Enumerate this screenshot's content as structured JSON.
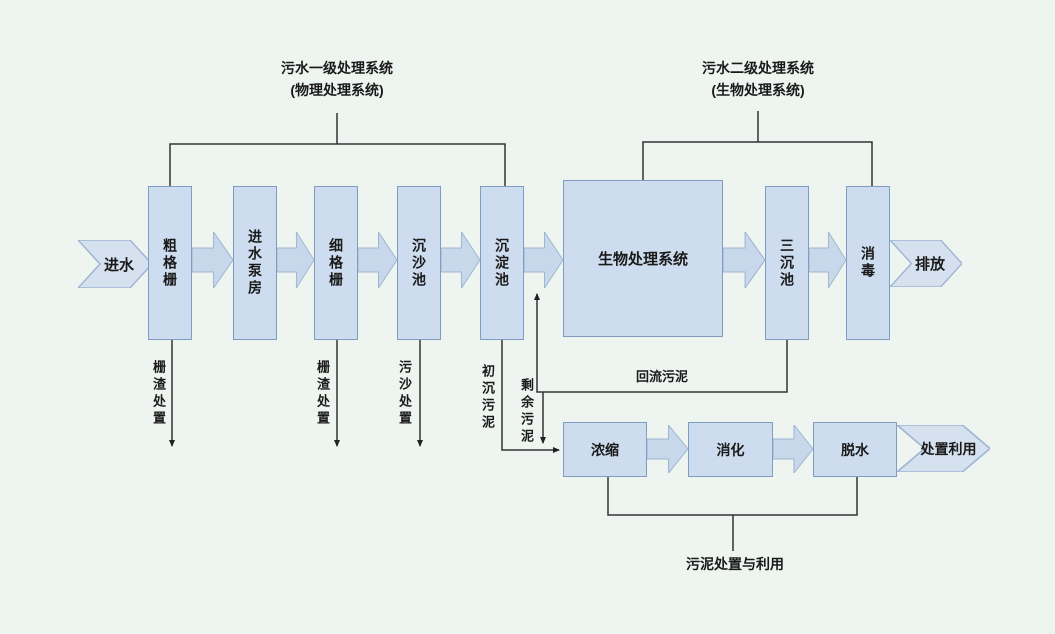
{
  "diagram": {
    "title_groups": [
      {
        "line1": "污水一级处理系统",
        "line2": "(物理处理系统)"
      },
      {
        "line1": "污水二级处理系统",
        "line2": "(生物处理系统)"
      }
    ],
    "inlet_arrow_label": "进水",
    "outlet_arrow_label": "排放",
    "primary_boxes": [
      "粗格栅",
      "进水泵房",
      "细格栅",
      "沉沙池",
      "沉淀池"
    ],
    "bio_box_label": "生物处理系统",
    "secondary_boxes": [
      "三沉池",
      "消毒"
    ],
    "waste_labels": [
      "栅渣处置",
      "栅渣处置",
      "污沙处置"
    ],
    "primary_sludge_label": "初沉污泥",
    "excess_sludge_label": "剩余污泥",
    "return_sludge_label": "回流污泥",
    "sludge_boxes": [
      "浓缩",
      "消化",
      "脱水"
    ],
    "sludge_outlet_label": "处置利用",
    "sludge_footer_label": "污泥处置与利用",
    "colors": {
      "background": "#eef4ef",
      "box_fill": "#cddcee",
      "box_border": "#7f9dc0",
      "arrow_fill": "#c7d8eb",
      "arrow_border": "#9db5d2",
      "chevron_fill": "#d6e1f0",
      "chevron_border": "#9fb6d4",
      "line": "#333333"
    }
  }
}
